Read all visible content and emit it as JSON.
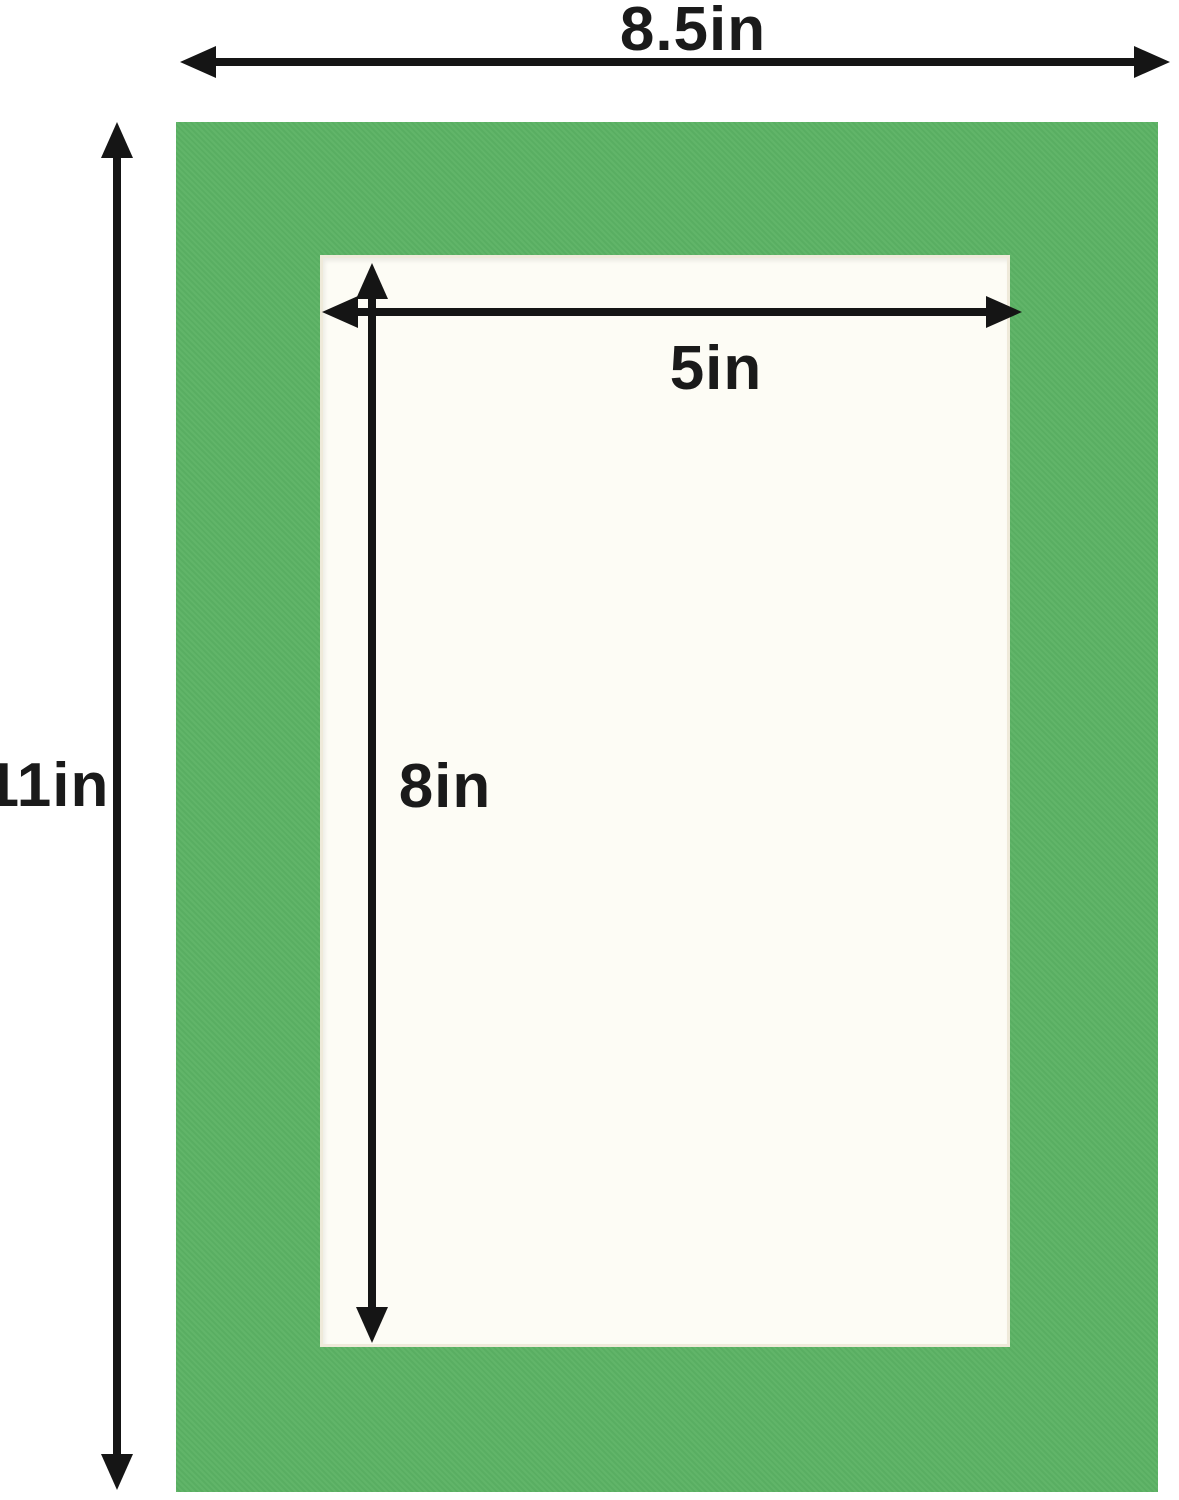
{
  "diagram": {
    "description": "Picture mat board dimension diagram",
    "dimensions": {
      "outer_width": {
        "label": "8.5in"
      },
      "outer_height": {
        "label": "11in"
      },
      "inner_width": {
        "label": "5in"
      },
      "inner_height": {
        "label": "8in"
      }
    },
    "colors": {
      "mat": "#5BB264",
      "window": "#FDFCF5",
      "arrow": "#151515",
      "label_text": "#1A1A1A",
      "background": "#FFFFFF"
    }
  }
}
